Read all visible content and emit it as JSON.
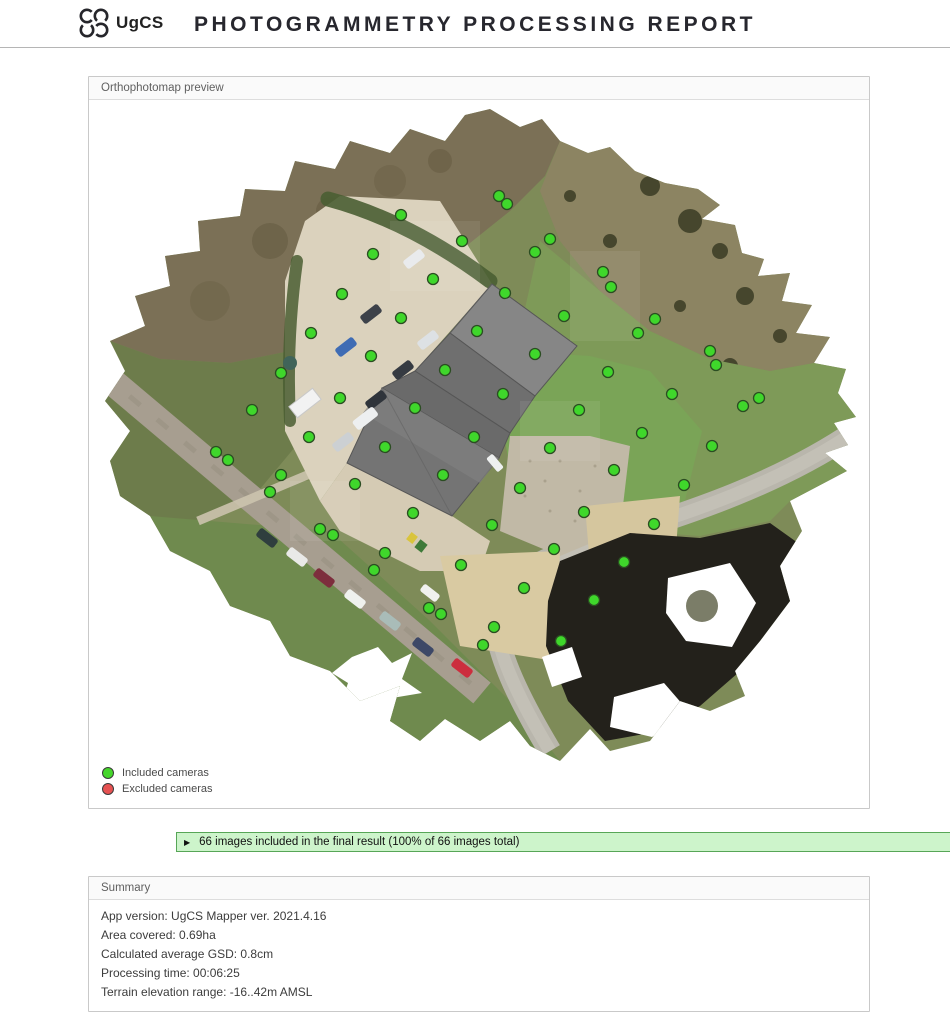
{
  "header": {
    "logo_text": "UgCS",
    "title": "PHOTOGRAMMETRY PROCESSING REPORT"
  },
  "orthophotomap": {
    "panel_title": "Orthophotomap preview",
    "legend": [
      {
        "label": "Included cameras",
        "color": "#46d62c"
      },
      {
        "label": "Excluded cameras",
        "color": "#e65252"
      }
    ],
    "camera_marker": {
      "included_color": "#3fd72b",
      "excluded_color": "#e65252",
      "outline_color": "#2b4d22",
      "radius": 5.5
    },
    "included_camera_positions": [
      [
        311,
        114
      ],
      [
        409,
        95
      ],
      [
        417,
        103
      ],
      [
        372,
        140
      ],
      [
        283,
        153
      ],
      [
        343,
        178
      ],
      [
        252,
        193
      ],
      [
        415,
        192
      ],
      [
        311,
        217
      ],
      [
        387,
        230
      ],
      [
        221,
        232
      ],
      [
        281,
        255
      ],
      [
        355,
        269
      ],
      [
        191,
        272
      ],
      [
        413,
        293
      ],
      [
        250,
        297
      ],
      [
        325,
        307
      ],
      [
        162,
        309
      ],
      [
        219,
        336
      ],
      [
        384,
        336
      ],
      [
        295,
        346
      ],
      [
        126,
        351
      ],
      [
        138,
        359
      ],
      [
        191,
        374
      ],
      [
        353,
        374
      ],
      [
        460,
        138
      ],
      [
        445,
        151
      ],
      [
        513,
        171
      ],
      [
        521,
        186
      ],
      [
        474,
        215
      ],
      [
        565,
        218
      ],
      [
        548,
        232
      ],
      [
        620,
        250
      ],
      [
        626,
        264
      ],
      [
        445,
        253
      ],
      [
        518,
        271
      ],
      [
        582,
        293
      ],
      [
        669,
        297
      ],
      [
        653,
        305
      ],
      [
        489,
        309
      ],
      [
        552,
        332
      ],
      [
        622,
        345
      ],
      [
        460,
        347
      ],
      [
        524,
        369
      ],
      [
        180,
        391
      ],
      [
        265,
        383
      ],
      [
        323,
        412
      ],
      [
        430,
        387
      ],
      [
        230,
        428
      ],
      [
        243,
        434
      ],
      [
        402,
        424
      ],
      [
        295,
        452
      ],
      [
        284,
        469
      ],
      [
        371,
        464
      ],
      [
        434,
        487
      ],
      [
        339,
        507
      ],
      [
        351,
        513
      ],
      [
        404,
        526
      ],
      [
        393,
        544
      ],
      [
        594,
        384
      ],
      [
        494,
        411
      ],
      [
        564,
        423
      ],
      [
        464,
        448
      ],
      [
        534,
        461
      ],
      [
        504,
        499
      ],
      [
        471,
        540
      ]
    ],
    "excluded_camera_positions": []
  },
  "images_banner": {
    "expand_arrow": "▶",
    "text": "66 images included in the final result (100% of 66 images total)",
    "background": "#cdf4cb",
    "border": "#57a657"
  },
  "summary": {
    "panel_title": "Summary",
    "rows": [
      "App version: UgCS Mapper ver. 2021.4.16",
      "Area covered: 0.69ha",
      "Calculated average GSD: 0.8cm",
      "Processing time: 00:06:25",
      "Terrain elevation range: -16..42m AMSL"
    ]
  }
}
